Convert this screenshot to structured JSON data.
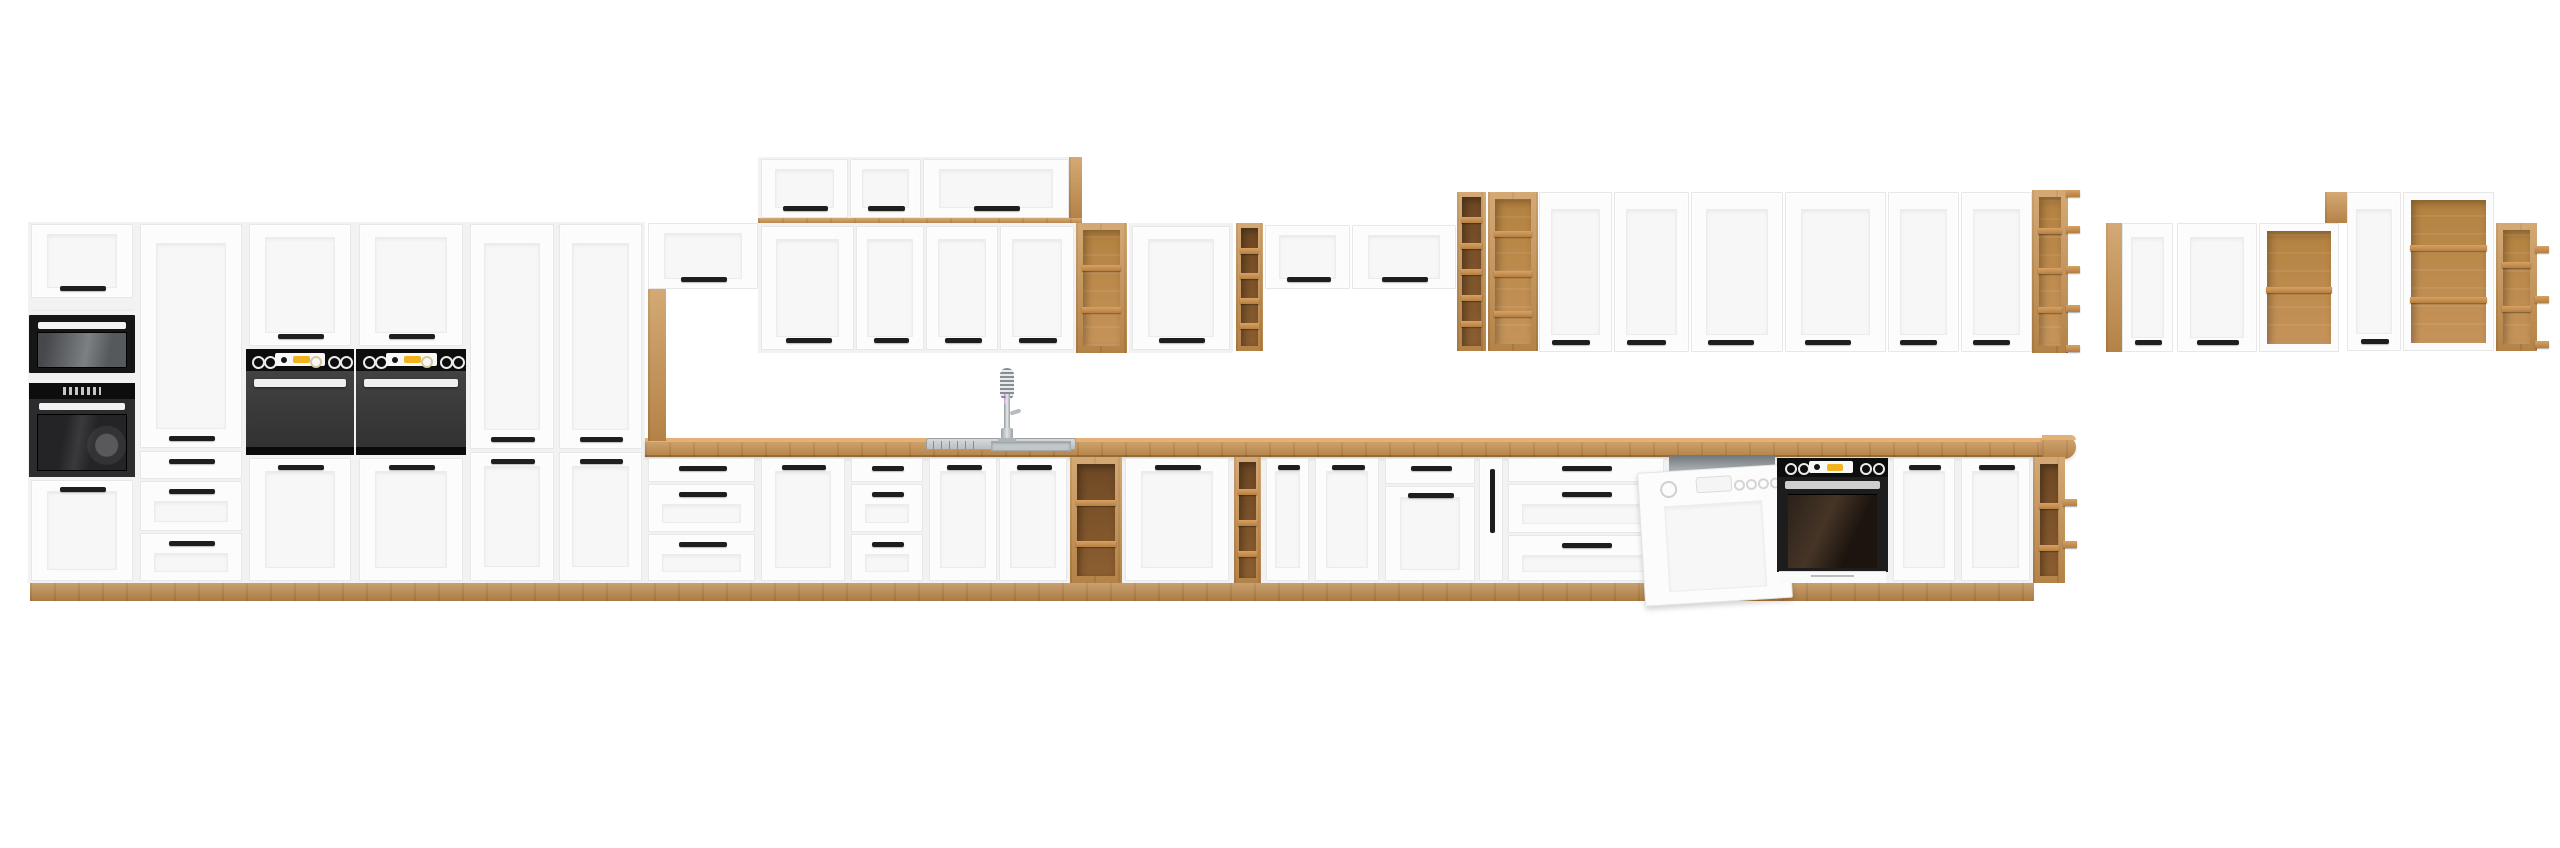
{
  "subject": "product render of a white and oak modular kitchen cabinet set with built-in appliances",
  "canvas": {
    "w": 2560,
    "h": 848
  },
  "background": "#ffffff",
  "colors": {
    "front": "#fcfcfc",
    "front_edge": "#e7e7e7",
    "panel": "#f7f7f7",
    "panel_line": "#ececec",
    "carcass": "#f2f2f2",
    "handle": "#1e1e1e",
    "wood": "#c8914f",
    "wood_top": "#e3b075",
    "steel": "#c3c8cb",
    "steel_dark": "#9aa0a3",
    "yellow": "#f2b41e",
    "black": "#0d0d0d",
    "oven_body": "#3a3a3a"
  },
  "appliances": [
    "microwave",
    "single-oven-tower",
    "double-built-in-ovens",
    "built-in-oven-with-base",
    "dishwasher-open-door",
    "sink-with-spring-faucet"
  ],
  "units": [
    {
      "n": "tall-run-carcass",
      "k": "bg",
      "b": [
        28,
        222,
        617,
        361
      ]
    },
    {
      "n": "base-run-carcass",
      "k": "bg",
      "b": [
        645,
        455,
        1390,
        128
      ]
    },
    {
      "n": "plinth",
      "k": "plinth",
      "b": [
        30,
        583,
        2004,
        18
      ]
    },
    {
      "n": "countertop",
      "k": "counter",
      "b": [
        645,
        438,
        1403,
        19
      ]
    },
    {
      "n": "countertop-rounded-end",
      "k": "endcap",
      "b": [
        2042,
        435,
        34,
        24
      ]
    },
    {
      "n": "oven-tower-top-door",
      "k": "door",
      "b": [
        31,
        224,
        102,
        74
      ],
      "hp": "b"
    },
    {
      "n": "panel-seam",
      "k": "line",
      "b": [
        31,
        309,
        102,
        2
      ]
    },
    {
      "n": "built-in-microwave",
      "k": "mw",
      "b": [
        29,
        315,
        106,
        58
      ]
    },
    {
      "n": "built-in-oven-tower",
      "k": "ovt",
      "b": [
        29,
        383,
        106,
        94
      ]
    },
    {
      "n": "oven-tower-bottom-door",
      "k": "door",
      "b": [
        31,
        480,
        102,
        101
      ],
      "hp": "t"
    },
    {
      "n": "tall-pantry-door",
      "k": "door",
      "b": [
        140,
        224,
        102,
        224
      ],
      "hp": "b"
    },
    {
      "n": "drawer-front",
      "k": "drawer",
      "b": [
        140,
        451,
        102,
        28
      ]
    },
    {
      "n": "drawer-front",
      "k": "drawer",
      "b": [
        140,
        481,
        102,
        50
      ],
      "pnl": 1
    },
    {
      "n": "drawer-front",
      "k": "drawer",
      "b": [
        140,
        533,
        102,
        48
      ],
      "pnl": 1
    },
    {
      "n": "oven-housing-top-door",
      "k": "door",
      "b": [
        249,
        224,
        102,
        122
      ],
      "hp": "b"
    },
    {
      "n": "built-in-double-oven",
      "k": "ov",
      "b": [
        246,
        349,
        108,
        106
      ]
    },
    {
      "n": "oven-housing-base-door",
      "k": "door",
      "b": [
        249,
        458,
        102,
        123
      ],
      "hp": "t"
    },
    {
      "n": "oven-housing-top-door",
      "k": "door",
      "b": [
        359,
        224,
        104,
        122
      ],
      "hp": "b"
    },
    {
      "n": "built-in-double-oven",
      "k": "ov",
      "b": [
        356,
        349,
        110,
        106
      ]
    },
    {
      "n": "oven-housing-base-door",
      "k": "door",
      "b": [
        359,
        458,
        104,
        123
      ],
      "hp": "t"
    },
    {
      "n": "tall-pantry-upper-door",
      "k": "door",
      "b": [
        470,
        224,
        84,
        225
      ],
      "hp": "b"
    },
    {
      "n": "tall-pantry-lower-door",
      "k": "door",
      "b": [
        470,
        452,
        84,
        129
      ],
      "hp": "t"
    },
    {
      "n": "tall-pantry-upper-door",
      "k": "door",
      "b": [
        559,
        224,
        83,
        225
      ],
      "hp": "b"
    },
    {
      "n": "tall-pantry-lower-door",
      "k": "door",
      "b": [
        559,
        452,
        83,
        129
      ],
      "hp": "t"
    },
    {
      "n": "wall-flap-cabinet-door",
      "k": "door",
      "b": [
        648,
        223,
        110,
        66
      ],
      "hp": "b"
    },
    {
      "n": "wood-support-panel",
      "k": "wood",
      "b": [
        648,
        289,
        18,
        152
      ]
    },
    {
      "n": "top-box-carcass",
      "k": "bg",
      "b": [
        758,
        157,
        324,
        67
      ]
    },
    {
      "n": "top-box-flap-door",
      "k": "door",
      "b": [
        761,
        159,
        87,
        59
      ],
      "hp": "b"
    },
    {
      "n": "top-box-flap-door",
      "k": "door",
      "b": [
        850,
        159,
        71,
        59
      ],
      "hp": "b"
    },
    {
      "n": "top-box-flap-door",
      "k": "door",
      "b": [
        923,
        159,
        146,
        59
      ],
      "hp": "b"
    },
    {
      "n": "wall-cabinet-top-strip",
      "k": "wood",
      "b": [
        758,
        218,
        324,
        6
      ]
    },
    {
      "n": "wood-end-wedge",
      "k": "wood",
      "b": [
        1069,
        157,
        13,
        61
      ]
    },
    {
      "n": "wall-cabinet-carcass",
      "k": "bg",
      "b": [
        758,
        223,
        319,
        130
      ]
    },
    {
      "n": "wall-cabinet-door",
      "k": "door",
      "b": [
        761,
        226,
        93,
        124
      ],
      "hp": "b"
    },
    {
      "n": "wall-cabinet-door",
      "k": "door",
      "b": [
        856,
        226,
        68,
        124
      ],
      "hp": "b"
    },
    {
      "n": "wall-cabinet-door",
      "k": "door",
      "b": [
        926,
        226,
        72,
        124
      ],
      "hp": "b"
    },
    {
      "n": "wall-cabinet-door",
      "k": "door",
      "b": [
        1000,
        226,
        74,
        124
      ],
      "hp": "b"
    },
    {
      "n": "open-wall-shelf",
      "k": "shelf",
      "b": [
        1076,
        223,
        51,
        130
      ],
      "frame": "wood",
      "tone": "mid",
      "div": [
        265,
        307
      ]
    },
    {
      "n": "wall-cabinet-carcass",
      "k": "bg",
      "b": [
        1129,
        223,
        104,
        130
      ]
    },
    {
      "n": "wall-cabinet-door",
      "k": "door",
      "b": [
        1132,
        226,
        98,
        124
      ],
      "hp": "b"
    },
    {
      "n": "narrow-wall-shelf",
      "k": "shelf",
      "b": [
        1236,
        223,
        27,
        128
      ],
      "frame": "wood",
      "tone": "dark",
      "div": [
        248,
        273,
        298,
        323
      ]
    },
    {
      "n": "wall-flap-cabinet-door",
      "k": "door",
      "b": [
        1265,
        225,
        85,
        64
      ],
      "hp": "b"
    },
    {
      "n": "wall-flap-cabinet-door",
      "k": "door",
      "b": [
        1352,
        225,
        104,
        64
      ],
      "hp": "b"
    },
    {
      "n": "narrow-wall-shelf",
      "k": "shelf",
      "b": [
        1457,
        192,
        29,
        159
      ],
      "frame": "wood",
      "tone": "dark",
      "div": [
        217,
        243,
        269,
        295,
        321
      ]
    },
    {
      "n": "open-wall-shelf",
      "k": "shelf",
      "b": [
        1488,
        192,
        50,
        159
      ],
      "frame": "wood",
      "tone": "mid",
      "div": [
        231,
        271,
        311
      ]
    },
    {
      "n": "tall-wall-cabinet-door",
      "k": "door",
      "b": [
        1539,
        192,
        73,
        160
      ],
      "hp": "b",
      "hx": 0.42
    },
    {
      "n": "tall-wall-cabinet-door",
      "k": "door",
      "b": [
        1614,
        192,
        75,
        160
      ],
      "hp": "b",
      "hx": 0.42
    },
    {
      "n": "tall-wall-cabinet-door",
      "k": "door",
      "b": [
        1691,
        192,
        92,
        160
      ],
      "hp": "b",
      "hx": 0.42
    },
    {
      "n": "tall-wall-cabinet-door",
      "k": "door",
      "b": [
        1785,
        192,
        101,
        160
      ],
      "hp": "b",
      "hx": 0.42
    },
    {
      "n": "tall-wall-cabinet-door",
      "k": "door",
      "b": [
        1888,
        192,
        71,
        160
      ],
      "hp": "b",
      "hx": 0.42
    },
    {
      "n": "tall-wall-cabinet-door",
      "k": "door",
      "b": [
        1961,
        192,
        71,
        160
      ],
      "hp": "b",
      "hx": 0.42
    },
    {
      "n": "corner-open-shelf",
      "k": "shelf",
      "b": [
        2032,
        190,
        36,
        163
      ],
      "frame": "wood",
      "tone": "mid",
      "div": [
        228,
        268,
        307
      ],
      "tb": [
        190,
        226,
        266,
        305,
        345
      ]
    },
    {
      "n": "wood-side-panel",
      "k": "wood",
      "b": [
        2106,
        223,
        16,
        129
      ]
    },
    {
      "n": "wall-cabinet-door",
      "k": "door",
      "b": [
        2122,
        223,
        51,
        129
      ],
      "hp": "b"
    },
    {
      "n": "wall-cabinet-door",
      "k": "door",
      "b": [
        2177,
        223,
        80,
        129
      ],
      "hp": "b"
    },
    {
      "n": "open-front-wall-cabinet",
      "k": "shelf",
      "b": [
        2259,
        223,
        80,
        129
      ],
      "frame": "white",
      "tone": "mid",
      "div": [
        286
      ]
    },
    {
      "n": "wood-filler",
      "k": "wood",
      "b": [
        2325,
        192,
        22,
        31
      ]
    },
    {
      "n": "tall-wall-cabinet-door",
      "k": "door",
      "b": [
        2347,
        192,
        54,
        159
      ],
      "hp": "b"
    },
    {
      "n": "open-front-wall-cabinet",
      "k": "shelf",
      "b": [
        2403,
        192,
        91,
        159
      ],
      "frame": "white",
      "tone": "mid",
      "div": [
        244,
        296
      ]
    },
    {
      "n": "corner-open-shelf",
      "k": "shelf",
      "b": [
        2496,
        223,
        41,
        128
      ],
      "frame": "wood",
      "tone": "mid",
      "div": [
        262,
        306
      ],
      "tb": [
        246,
        296,
        341
      ]
    },
    {
      "n": "drawer-front",
      "k": "drawer",
      "b": [
        648,
        458,
        107,
        24
      ]
    },
    {
      "n": "drawer-front",
      "k": "drawer",
      "b": [
        648,
        484,
        107,
        48
      ],
      "pnl": 1
    },
    {
      "n": "drawer-front",
      "k": "drawer",
      "b": [
        648,
        534,
        107,
        47
      ],
      "pnl": 1
    },
    {
      "n": "base-cabinet-door",
      "k": "door",
      "b": [
        761,
        458,
        84,
        123
      ],
      "hp": "t"
    },
    {
      "n": "drawer-front",
      "k": "drawer",
      "b": [
        851,
        458,
        72,
        24
      ]
    },
    {
      "n": "drawer-front",
      "k": "drawer",
      "b": [
        851,
        484,
        72,
        48
      ],
      "pnl": 1
    },
    {
      "n": "drawer-front",
      "k": "drawer",
      "b": [
        851,
        534,
        72,
        47
      ],
      "pnl": 1
    },
    {
      "n": "sink-cabinet-door",
      "k": "door",
      "b": [
        929,
        458,
        68,
        123
      ],
      "hp": "t"
    },
    {
      "n": "sink-cabinet-door",
      "k": "door",
      "b": [
        999,
        458,
        68,
        123
      ],
      "hp": "t"
    },
    {
      "n": "open-base-shelf",
      "k": "shelf",
      "b": [
        1070,
        457,
        52,
        126
      ],
      "frame": "wood",
      "tone": "dark",
      "div": [
        500,
        541
      ]
    },
    {
      "n": "base-cabinet-door",
      "k": "door",
      "b": [
        1125,
        458,
        104,
        123
      ],
      "hp": "t"
    },
    {
      "n": "narrow-base-shelf",
      "k": "shelf",
      "b": [
        1234,
        457,
        27,
        126
      ],
      "frame": "wood",
      "tone": "dark",
      "div": [
        489,
        520,
        551
      ]
    },
    {
      "n": "base-cabinet-door",
      "k": "door",
      "b": [
        1266,
        458,
        43,
        123
      ],
      "hp": "t"
    },
    {
      "n": "base-cabinet-door",
      "k": "door",
      "b": [
        1315,
        458,
        64,
        123
      ],
      "hp": "t"
    },
    {
      "n": "drawer-front",
      "k": "drawer",
      "b": [
        1385,
        458,
        90,
        26
      ]
    },
    {
      "n": "base-cabinet-door",
      "k": "door",
      "b": [
        1385,
        486,
        90,
        95
      ],
      "hp": "t"
    },
    {
      "n": "cargo-pullout",
      "k": "cargo",
      "b": [
        1479,
        458,
        24,
        123
      ]
    },
    {
      "n": "drawer-front",
      "k": "drawer",
      "b": [
        1508,
        458,
        156,
        24
      ]
    },
    {
      "n": "drawer-front",
      "k": "drawer",
      "b": [
        1508,
        484,
        156,
        49
      ],
      "pnl": 1
    },
    {
      "n": "drawer-front",
      "k": "drawer",
      "b": [
        1508,
        535,
        156,
        46
      ],
      "pnl": 1
    },
    {
      "n": "dishwasher",
      "k": "dw",
      "b": [
        1667,
        455,
        110,
        128
      ]
    },
    {
      "n": "built-in-oven-base",
      "k": "ovb",
      "b": [
        1777,
        458,
        111,
        125
      ]
    },
    {
      "n": "base-cabinet-door",
      "k": "door",
      "b": [
        1893,
        458,
        62,
        123
      ],
      "hp": "t"
    },
    {
      "n": "base-cabinet-door",
      "k": "door",
      "b": [
        1961,
        458,
        69,
        123
      ],
      "hp": "t"
    },
    {
      "n": "corner-base-shelf",
      "k": "shelf",
      "b": [
        2033,
        457,
        32,
        126
      ],
      "frame": "wood",
      "tone": "dark",
      "div": [
        503,
        545
      ],
      "tb": [
        499,
        541
      ]
    },
    {
      "n": "sink",
      "k": "sink",
      "b": [
        926,
        438,
        150,
        12
      ]
    },
    {
      "n": "faucet",
      "k": "faucet",
      "b": [
        990,
        368,
        34,
        74
      ]
    }
  ]
}
